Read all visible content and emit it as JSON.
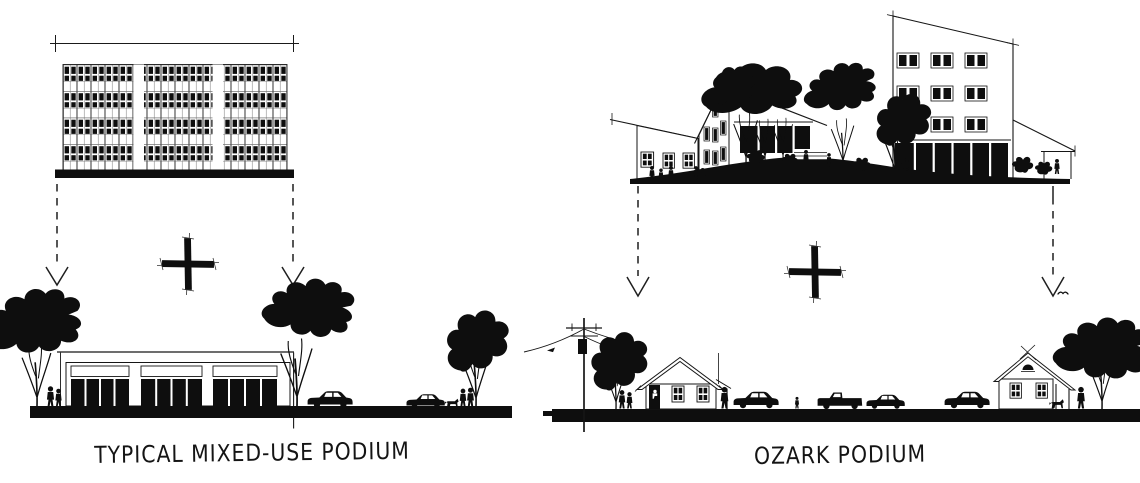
{
  "canvas": {
    "width": 1140,
    "height": 483,
    "background": "#ffffff",
    "ink": "#101010"
  },
  "panels": {
    "left": {
      "caption": "TYPICAL MIXED-USE PODIUM",
      "operator_symbol": "plus",
      "arrow_symbol": "dashed-down-arrow"
    },
    "right": {
      "caption": "OZARK PODIUM",
      "operator_symbol": "plus",
      "arrow_symbol": "dashed-down-arrow"
    }
  }
}
